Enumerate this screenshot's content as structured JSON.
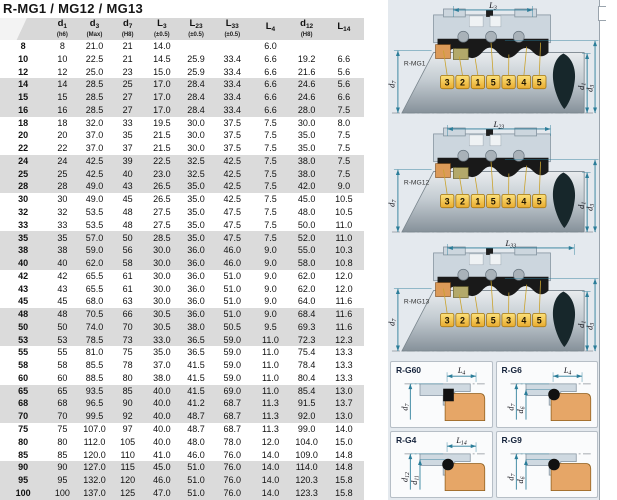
{
  "title": "R-MG1 / MG12 / MG13",
  "table": {
    "headers": [
      {
        "base": "",
        "sub": "",
        "note": ""
      },
      {
        "base": "d",
        "sub": "1",
        "note": "(h6)"
      },
      {
        "base": "d",
        "sub": "3",
        "note": "(Max)"
      },
      {
        "base": "d",
        "sub": "7",
        "note": "(H8)"
      },
      {
        "base": "L",
        "sub": "3",
        "note": "(±0.5)"
      },
      {
        "base": "L",
        "sub": "23",
        "note": "(±0.5)"
      },
      {
        "base": "L",
        "sub": "33",
        "note": "(±0.5)"
      },
      {
        "base": "L",
        "sub": "4",
        "note": ""
      },
      {
        "base": "d",
        "sub": "12",
        "note": "(H8)"
      },
      {
        "base": "L",
        "sub": "14",
        "note": ""
      }
    ],
    "rows": [
      [
        "8",
        "8",
        "21.0",
        "21",
        "14.0",
        "",
        "",
        "6.0",
        "",
        ""
      ],
      [
        "10",
        "10",
        "22.5",
        "21",
        "14.5",
        "25.9",
        "33.4",
        "6.6",
        "19.2",
        "6.6"
      ],
      [
        "12",
        "12",
        "25.0",
        "23",
        "15.0",
        "25.9",
        "33.4",
        "6.6",
        "21.6",
        "5.6"
      ],
      [
        "14",
        "14",
        "28.5",
        "25",
        "17.0",
        "28.4",
        "33.4",
        "6.6",
        "24.6",
        "5.6"
      ],
      [
        "15",
        "15",
        "28.5",
        "27",
        "17.0",
        "28.4",
        "33.4",
        "6.6",
        "24.6",
        "6.6"
      ],
      [
        "16",
        "16",
        "28.5",
        "27",
        "17.0",
        "28.4",
        "33.4",
        "6.6",
        "28.0",
        "7.5"
      ],
      [
        "18",
        "18",
        "32.0",
        "33",
        "19.5",
        "30.0",
        "37.5",
        "7.5",
        "30.0",
        "8.0"
      ],
      [
        "20",
        "20",
        "37.0",
        "35",
        "21.5",
        "30.0",
        "37.5",
        "7.5",
        "35.0",
        "7.5"
      ],
      [
        "22",
        "22",
        "37.0",
        "37",
        "21.5",
        "30.0",
        "37.5",
        "7.5",
        "35.0",
        "7.5"
      ],
      [
        "24",
        "24",
        "42.5",
        "39",
        "22.5",
        "32.5",
        "42.5",
        "7.5",
        "38.0",
        "7.5"
      ],
      [
        "25",
        "25",
        "42.5",
        "40",
        "23.0",
        "32.5",
        "42.5",
        "7.5",
        "38.0",
        "7.5"
      ],
      [
        "28",
        "28",
        "49.0",
        "43",
        "26.5",
        "35.0",
        "42.5",
        "7.5",
        "42.0",
        "9.0"
      ],
      [
        "30",
        "30",
        "49.0",
        "45",
        "26.5",
        "35.0",
        "42.5",
        "7.5",
        "45.0",
        "10.5"
      ],
      [
        "32",
        "32",
        "53.5",
        "48",
        "27.5",
        "35.0",
        "47.5",
        "7.5",
        "48.0",
        "10.5"
      ],
      [
        "33",
        "33",
        "53.5",
        "48",
        "27.5",
        "35.0",
        "47.5",
        "7.5",
        "50.0",
        "11.0"
      ],
      [
        "35",
        "35",
        "57.0",
        "50",
        "28.5",
        "35.0",
        "47.5",
        "7.5",
        "52.0",
        "11.0"
      ],
      [
        "38",
        "38",
        "59.0",
        "56",
        "30.0",
        "36.0",
        "46.0",
        "9.0",
        "55.0",
        "10.3"
      ],
      [
        "40",
        "40",
        "62.0",
        "58",
        "30.0",
        "36.0",
        "46.0",
        "9.0",
        "58.0",
        "10.8"
      ],
      [
        "42",
        "42",
        "65.5",
        "61",
        "30.0",
        "36.0",
        "51.0",
        "9.0",
        "62.0",
        "12.0"
      ],
      [
        "43",
        "43",
        "65.5",
        "61",
        "30.0",
        "36.0",
        "51.0",
        "9.0",
        "62.0",
        "12.0"
      ],
      [
        "45",
        "45",
        "68.0",
        "63",
        "30.0",
        "36.0",
        "51.0",
        "9.0",
        "64.0",
        "11.6"
      ],
      [
        "48",
        "48",
        "70.5",
        "66",
        "30.5",
        "36.0",
        "51.0",
        "9.0",
        "68.4",
        "11.6"
      ],
      [
        "50",
        "50",
        "74.0",
        "70",
        "30.5",
        "38.0",
        "50.5",
        "9.5",
        "69.3",
        "11.6"
      ],
      [
        "53",
        "53",
        "78.5",
        "73",
        "33.0",
        "36.5",
        "59.0",
        "11.0",
        "72.3",
        "12.3"
      ],
      [
        "55",
        "55",
        "81.0",
        "75",
        "35.0",
        "36.5",
        "59.0",
        "11.0",
        "75.4",
        "13.3"
      ],
      [
        "58",
        "58",
        "85.5",
        "78",
        "37.0",
        "41.5",
        "59.0",
        "11.0",
        "78.4",
        "13.3"
      ],
      [
        "60",
        "60",
        "88.5",
        "80",
        "38.0",
        "41.5",
        "59.0",
        "11.0",
        "80.4",
        "13.3"
      ],
      [
        "65",
        "65",
        "93.5",
        "85",
        "40.0",
        "41.5",
        "69.0",
        "11.0",
        "85.4",
        "13.0"
      ],
      [
        "68",
        "68",
        "96.5",
        "90",
        "40.0",
        "41.2",
        "68.7",
        "11.3",
        "91.5",
        "13.7"
      ],
      [
        "70",
        "70",
        "99.5",
        "92",
        "40.0",
        "48.7",
        "68.7",
        "11.3",
        "92.0",
        "13.0"
      ],
      [
        "75",
        "75",
        "107.0",
        "97",
        "40.0",
        "48.7",
        "68.7",
        "11.3",
        "99.0",
        "14.0"
      ],
      [
        "80",
        "80",
        "112.0",
        "105",
        "40.0",
        "48.0",
        "78.0",
        "12.0",
        "104.0",
        "15.0"
      ],
      [
        "85",
        "85",
        "120.0",
        "110",
        "41.0",
        "46.0",
        "76.0",
        "14.0",
        "109.0",
        "14.8"
      ],
      [
        "90",
        "90",
        "127.0",
        "115",
        "45.0",
        "51.0",
        "76.0",
        "14.0",
        "114.0",
        "14.8"
      ],
      [
        "95",
        "95",
        "132.0",
        "120",
        "46.0",
        "51.0",
        "76.0",
        "14.0",
        "120.3",
        "15.8"
      ],
      [
        "100",
        "100",
        "137.0",
        "125",
        "47.0",
        "51.0",
        "76.0",
        "14.0",
        "123.3",
        "15.8"
      ]
    ]
  },
  "diagrams": {
    "tags": [
      "3",
      "2",
      "1",
      "5",
      "3",
      "4",
      "5"
    ],
    "dim_labels": {
      "left": {
        "base": "d",
        "sub": "7"
      },
      "right1": {
        "base": "d",
        "sub": "1"
      },
      "right2": {
        "base": "d",
        "sub": "3"
      }
    },
    "main": [
      {
        "name": "R-MG1",
        "top_dim": {
          "base": "L",
          "sub": "3"
        }
      },
      {
        "name": "R-MG12",
        "top_dim": {
          "base": "L",
          "sub": "23"
        }
      },
      {
        "name": "R-MG13",
        "top_dim": {
          "base": "L",
          "sub": "33"
        }
      }
    ],
    "small": [
      {
        "name": "R-G60",
        "top_dim": {
          "base": "L",
          "sub": "4"
        },
        "left_dims": [
          {
            "base": "d",
            "sub": "7"
          }
        ]
      },
      {
        "name": "R-G6",
        "top_dim": {
          "base": "L",
          "sub": "4"
        },
        "left_dims": [
          {
            "base": "d",
            "sub": "7"
          },
          {
            "base": "d",
            "sub": "6"
          }
        ]
      },
      {
        "name": "R-G4",
        "top_dim": {
          "base": "L",
          "sub": "14"
        },
        "left_dims": [
          {
            "base": "d",
            "sub": "12"
          },
          {
            "base": "d",
            "sub": "11"
          }
        ]
      },
      {
        "name": "R-G9",
        "top_dim": null,
        "left_dims": [
          {
            "base": "d",
            "sub": "7"
          },
          {
            "base": "d",
            "sub": "6"
          }
        ]
      }
    ],
    "colors": {
      "dimension": "#2b7d99",
      "tag_fill": "#f2c23f",
      "seat_orange": "#dc9a58",
      "seat_olive": "#b3a96b",
      "housing": "#ccd6de",
      "bellows": "#191919"
    }
  }
}
